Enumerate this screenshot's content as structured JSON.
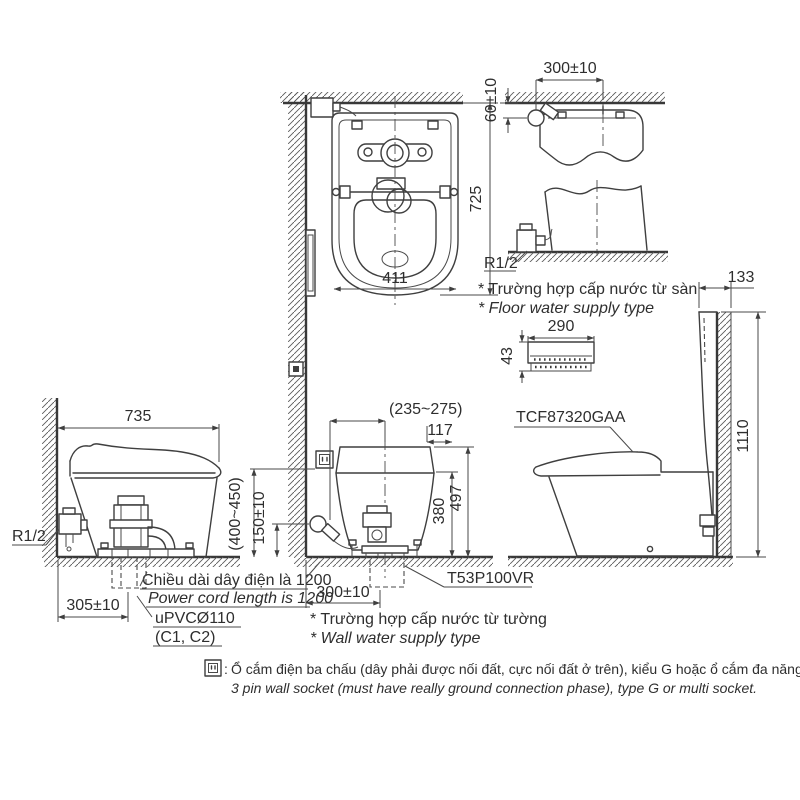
{
  "plan": {
    "dim_depth": "725",
    "dim_width": "411"
  },
  "floor_supply": {
    "dim_offset": "300±10",
    "dim_height": "60±10",
    "thread": "R1/2",
    "caption_vi": "* Trường hợp cấp nước từ sàn",
    "caption_en": "* Floor water supply type"
  },
  "remote": {
    "dim_width": "290",
    "dim_height": "43"
  },
  "right_view": {
    "model": "TCF87320GAA",
    "dim_offset": "133",
    "dim_height": "1110"
  },
  "left_view": {
    "dim_depth": "735",
    "thread": "R1/2",
    "dim_drain": "305±10",
    "cord_vi": "Chiều dài dây điện là 1200",
    "cord_en": "Power cord length is 1200",
    "pipe": "uPVCØ110",
    "pipe_sub": "(C1, C2)"
  },
  "front_view": {
    "dim_supply_offset": "(235~275)",
    "dim_117": "117",
    "dim_h497": "497",
    "dim_h380": "380",
    "dim_socket_h": "(400~450)",
    "dim_supply_h": "150±10",
    "dim_drain": "300±10",
    "model": "T53P100VR",
    "caption_vi": "* Trường hợp cấp nước từ tường",
    "caption_en": "* Wall water supply type"
  },
  "footnote": {
    "colon": ":",
    "vi": "Ổ cắm điện ba chấu (dây phải được nối đất, cực nối đất ở trên), kiểu G hoặc ổ cắm đa năng.",
    "en": "3 pin wall socket (must have really ground connection phase), type G or multi socket."
  }
}
